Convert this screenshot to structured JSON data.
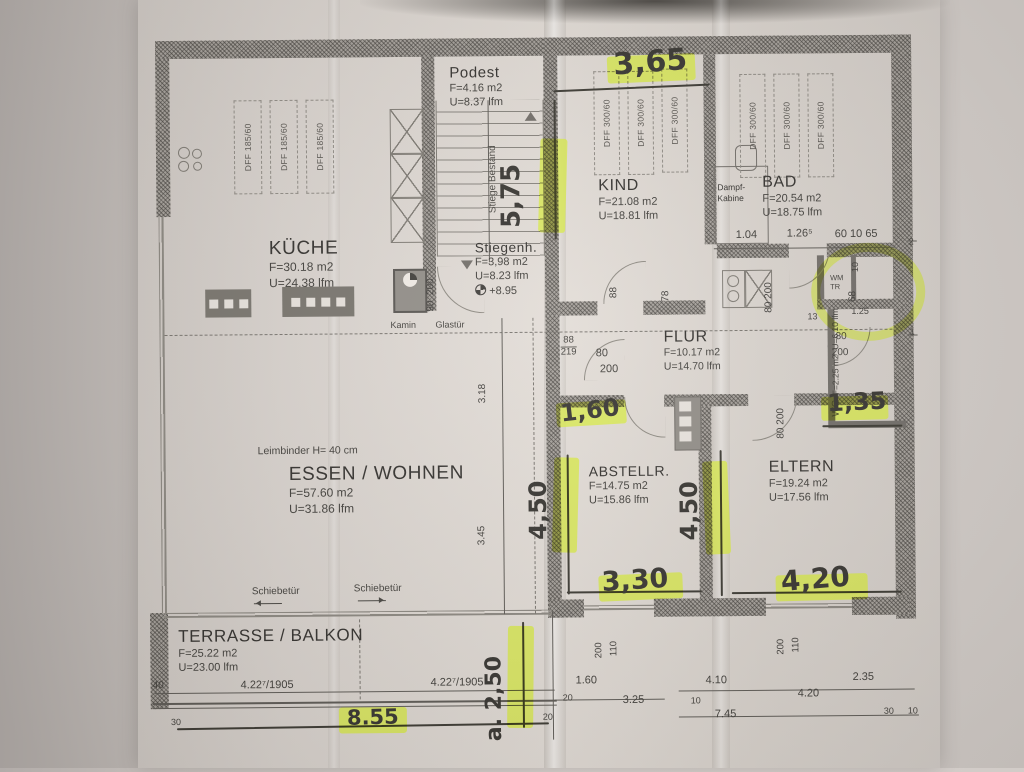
{
  "rooms": {
    "podest": {
      "name": "Podest",
      "area": "F=4.16 m2",
      "perimeter": "U=8.37 lfm"
    },
    "kueche": {
      "name": "KÜCHE",
      "area": "F=30.18 m2",
      "perimeter": "U=24.38 lfm"
    },
    "stiegenhaus": {
      "name": "Stiegenh.",
      "area": "F=3,98 m2",
      "perimeter": "U=8.23 lfm",
      "level": "+8.95"
    },
    "kind": {
      "name": "KIND",
      "area": "F=21.08 m2",
      "perimeter": "U=18.81 lfm"
    },
    "bad": {
      "name": "BAD",
      "area": "F=20.54 m2",
      "perimeter": "U=18.75 lfm"
    },
    "dampfkabine": {
      "line1": "Dampf-",
      "line2": "Kabine"
    },
    "flur": {
      "name": "FLUR",
      "area": "F=10.17 m2",
      "perimeter": "U=14.70 lfm"
    },
    "wc": {
      "name": "WC",
      "area": "F=2.25 m2",
      "perimeter": "U=6.10 lfm"
    },
    "abstellraum": {
      "name": "ABSTELLR.",
      "area": "F=14.75 m2",
      "perimeter": "U=15.86 lfm"
    },
    "eltern": {
      "name": "ELTERN",
      "area": "F=19.24 m2",
      "perimeter": "U=17.56 lfm"
    },
    "essen_wohnen": {
      "name": "ESSEN / WOHNEN",
      "area": "F=57.60 m2",
      "perimeter": "U=31.86 lfm"
    },
    "terrasse": {
      "name": "TERRASSE / BALKON",
      "area": "F=25.22 m2",
      "perimeter": "U=23.00 lfm"
    }
  },
  "windows": {
    "roof_small": "DFF 185/60",
    "roof_large": "DFF 300/60"
  },
  "annotations": {
    "leimbinder": "Leimbinder H= 40 cm",
    "schiebetuer": "Schiebetür",
    "kamin": "Kamin",
    "glastuer": "Glastür",
    "stiege": "Stiege Bestand",
    "wm": "WM",
    "tr": "TR"
  },
  "dims": {
    "bad_1": "1.04",
    "bad_2": "1.26⁵",
    "bad_3": "60 10 65",
    "glast_w": "90",
    "glast_h": "200",
    "flur_88": "88",
    "flur_219": "219",
    "flur_80": "80",
    "flur_200": "200",
    "kind_door": "88",
    "niche_78": "78",
    "flur2_80": "80",
    "flur2_200": "200",
    "wall_13": "13",
    "wm_125": "1.25",
    "wm_10": "10",
    "wm_68": "68",
    "wc_80": "80",
    "wc_200": "200",
    "tick_2": "2",
    "tick_1": "1",
    "v_318": "3.18",
    "v_345": "3.45",
    "eltern_80": "80",
    "eltern_200": "200",
    "win1_200": "200",
    "win1_110": "110",
    "win2_200": "200",
    "win2_110": "110",
    "b_20": "20",
    "b_160": "1.60",
    "b_325": "3.25",
    "b_410": "4.10",
    "b_10": "10",
    "b_745": "7.45",
    "b_420": "4.20",
    "b_235": "2.35",
    "br_30": "30",
    "br_10": "10",
    "t_40": "40",
    "t_422a": "4.22⁷/1905",
    "t_422b": "4.22⁷/1905",
    "t_30": "30",
    "t_20": "20"
  },
  "handwritten": {
    "h365": "3,65",
    "h575": "5,75",
    "h160": "1,60",
    "h450l": "4,50",
    "h450r": "4,50",
    "h330": "3,30",
    "h420": "4,20",
    "h135": "1,35",
    "h250": "a. 2,50",
    "h855": "8.55"
  },
  "colors": {
    "highlighter": "#d8e94c",
    "ink": "#3c3a37",
    "pencil": "#34322f",
    "wall": "#79756f",
    "paper": "#dcd6d1"
  }
}
